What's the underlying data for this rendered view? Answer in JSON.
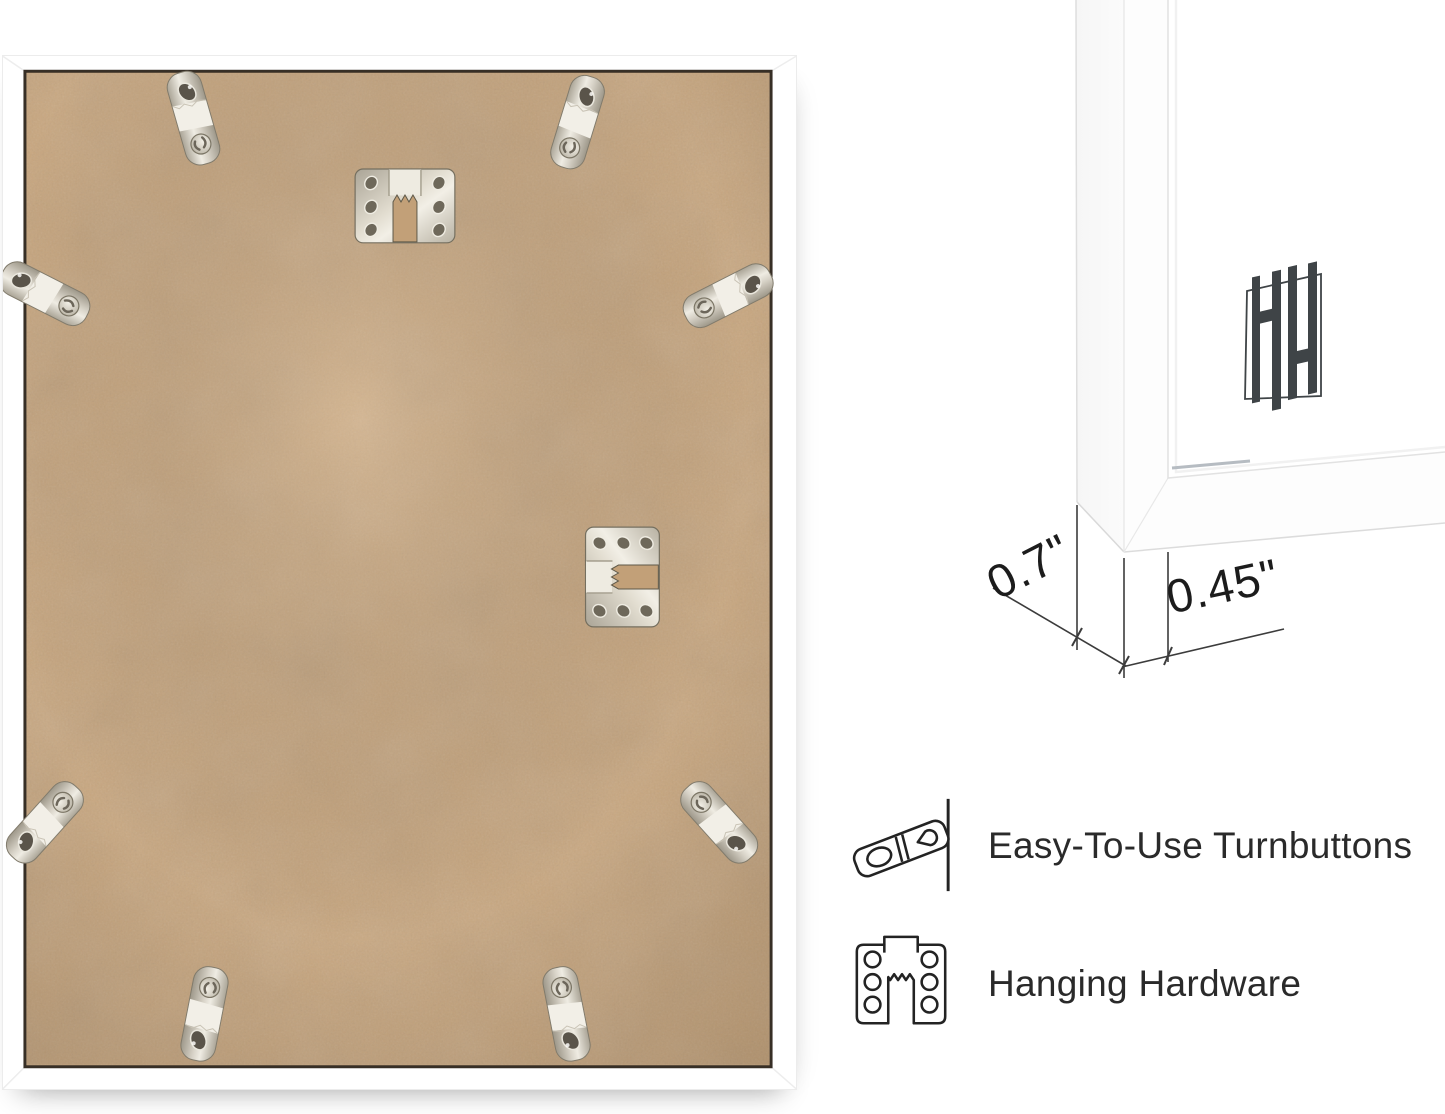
{
  "photo": {
    "subject": "picture-frame-back",
    "frame_color": "#ffffff",
    "backing_board_color": "#c8a67e",
    "board_edge_shadow": "#372f26",
    "hardware_finish": "#d8d3c8",
    "turnbutton_count": 8,
    "sawtooth_hanger_count": 2
  },
  "corner_diagram": {
    "frame_color": "#ffffff",
    "logo": "hh-monogram",
    "logo_color": "#3f4447",
    "measurements": {
      "side_depth": "0.7\"",
      "face_width": "0.45\""
    }
  },
  "features": [
    {
      "icon": "turnbutton-icon",
      "label": "Easy-To-Use Turnbuttons"
    },
    {
      "icon": "hanging-hardware-icon",
      "label": "Hanging Hardware"
    }
  ],
  "text_color": "#2a2a2a"
}
